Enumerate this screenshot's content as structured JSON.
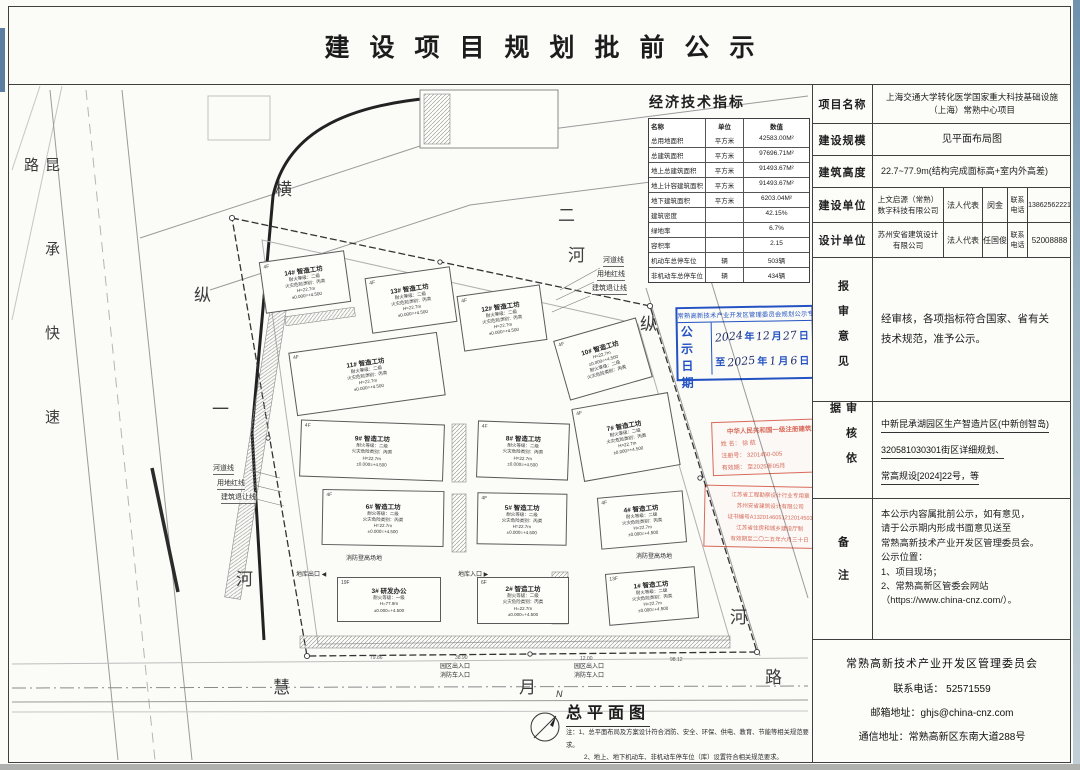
{
  "title": "建设项目规划批前公示",
  "eco_table": {
    "title": "经济技术指标",
    "headers": [
      "名称",
      "单位",
      "数值"
    ],
    "rows": [
      [
        "总用地面积",
        "平方米",
        "42583.00M²"
      ],
      [
        "总建筑面积",
        "平方米",
        "97696.71M²"
      ],
      [
        "地上总建筑面积",
        "平方米",
        "91493.67M²"
      ],
      [
        "地上计容建筑面积",
        "平方米",
        "91493.67M²"
      ],
      [
        "地下建筑面积",
        "平方米",
        "6203.04M²"
      ],
      [
        "建筑密度",
        "",
        "42.15%"
      ],
      [
        "绿地率",
        "",
        "6.7%"
      ],
      [
        "容积率",
        "",
        "2.15"
      ],
      [
        "机动车总停车位",
        "辆",
        "503辆"
      ],
      [
        "非机动车总停车位",
        "辆",
        "434辆"
      ]
    ]
  },
  "info_panel": {
    "project_label": "项目名称",
    "project_value": "上海交通大学转化医学国家重大科技基础设施\n（上海）常熟中心项目",
    "scale_label": "建设规模",
    "scale_value": "见平面布局图",
    "height_label": "建筑高度",
    "height_value": "22.7~77.9m(结构完成面标高+室内外高差)",
    "builder_label": "建设单位",
    "builder_company": "上文启源（常熟）\n数字科技有限公司",
    "builder_rep_label": "法人代表",
    "builder_rep": "闵金",
    "builder_tel_label": "联系\n电话",
    "builder_tel": "13862562221",
    "designer_label": "设计单位",
    "designer_company": "苏州安省建筑设计\n有限公司",
    "designer_rep_label": "法人代表",
    "designer_rep": "任国俊",
    "designer_tel_label": "联系\n电话",
    "designer_tel": "52008888",
    "opinion_label": "报审意见",
    "opinion_text": "经审核，各项指标符合国家、省有关\n技术规范，准予公示。",
    "basis_label": "审核依据",
    "basis_lines": [
      "中新昆承湖园区生产智造片区(中新创智岛)",
      "320581030301街区详细规划、",
      "常高规设[2024]22号，等"
    ],
    "remark_label": "备注",
    "remark_text": "本公示内容属批前公示，如有意见，\n请于公示期内形成书面意见送至\n常熟高新技术产业开发区管理委员会。\n公示位置：\n1、项目现场；\n2、常熟高新区管委会网站\n（https://www.china-cnz.com/）。",
    "footer_org": "常熟高新技术产业开发区管理委员会",
    "footer_tel": "联系电话：  52571559",
    "footer_email": "邮箱地址：ghjs@china-cnz.com",
    "footer_addr": "通信地址：常熟高新区东南大道288号"
  },
  "plan": {
    "roads": {
      "left_expressway": "昆承快速路",
      "top_river": [
        "横",
        "二",
        "河"
      ],
      "west_river": [
        "纵",
        "一",
        "河"
      ],
      "east_river": [
        "纵",
        "河"
      ],
      "south_road": [
        "慧",
        "月",
        "路"
      ]
    },
    "buildings": [
      {
        "id": "b14",
        "name": "14# 智造工坊",
        "floors": "4F",
        "lines": "耐火等级：二级\n火灾危险类别：丙类\nH=22.7m\n±0.000=+4.500",
        "x": 254,
        "y": 171,
        "w": 86,
        "h": 52,
        "rot": -8
      },
      {
        "id": "b13",
        "name": "13# 智造工坊",
        "floors": "4F",
        "lines": "耐火等级：二级\n火灾危险类别：丙类\nH=22.7m\n±0.000=+4.500",
        "x": 360,
        "y": 187,
        "w": 86,
        "h": 56,
        "rot": -8
      },
      {
        "id": "b12",
        "name": "12# 智造工坊",
        "floors": "4F",
        "lines": "耐火等级：二级\n火灾危险类别：丙类\nH=22.7m\n±0.000=+4.500",
        "x": 452,
        "y": 205,
        "w": 84,
        "h": 56,
        "rot": -8
      },
      {
        "id": "b11",
        "name": "11# 智造工坊",
        "floors": "4F",
        "lines": "耐火等级：二级\n火灾危险类别：丙类\nH=22.7m\n±0.000=+4.500",
        "x": 284,
        "y": 257,
        "w": 150,
        "h": 64,
        "rot": -8
      },
      {
        "id": "b10",
        "name": "10# 智造工坊",
        "floors": "4F",
        "lines": "H=22.7m\n±0.000=+4.500\n耐火等级：二级\n火灾危险类别：丙类",
        "x": 552,
        "y": 243,
        "w": 86,
        "h": 62,
        "rot": -16
      },
      {
        "id": "b9",
        "name": "9# 智造工坊",
        "floors": "4F",
        "lines": "耐火等级：二级\n火灾危险类别：丙类\nH=22.7m\n±0.000=+4.500",
        "x": 292,
        "y": 337,
        "w": 144,
        "h": 57,
        "rot": 2
      },
      {
        "id": "b8",
        "name": "8# 智造工坊",
        "floors": "4F",
        "lines": "耐火等级：二级\n火灾危险类别：丙类\nH=22.7m\n±0.000=+4.500",
        "x": 469,
        "y": 337,
        "w": 92,
        "h": 57,
        "rot": 2
      },
      {
        "id": "b7",
        "name": "7# 智造工坊",
        "floors": "4F",
        "lines": "耐火等级：二级\n火灾危险类别：丙类\nH=22.7m\n±0.000=+4.500",
        "x": 569,
        "y": 315,
        "w": 98,
        "h": 74,
        "rot": -10
      },
      {
        "id": "b6",
        "name": "6# 智造工坊",
        "floors": "4F",
        "lines": "耐火等级：二级\n火灾危险类别：丙类\nH=22.7m\n±0.000=+4.500",
        "x": 314,
        "y": 405,
        "w": 122,
        "h": 56,
        "rot": 1
      },
      {
        "id": "b5",
        "name": "5# 智造工坊",
        "floors": "4F",
        "lines": "耐火等级：二级\n火灾危险类别：丙类\nH=22.7m\n±0.000=+4.500",
        "x": 469,
        "y": 408,
        "w": 90,
        "h": 52,
        "rot": 1
      },
      {
        "id": "b4",
        "name": "4# 智造工坊",
        "floors": "4F",
        "lines": "耐火等级：二级\n火灾危险类别：丙类\nH=22.7m\n±0.000=+4.500",
        "x": 591,
        "y": 409,
        "w": 86,
        "h": 52,
        "rot": -5
      },
      {
        "id": "b3",
        "name": "3# 研发办公",
        "floors": "19F",
        "lines": "耐火等级：一级\nH=77.9m\n±0.000=+4.500",
        "x": 329,
        "y": 492,
        "w": 104,
        "h": 45,
        "rot": 0
      },
      {
        "id": "b2",
        "name": "2# 智造工坊",
        "floors": "6F",
        "lines": "耐火等级：二级\n火灾危险类别：丙类\nH=22.7m\n±0.000=+4.500",
        "x": 469,
        "y": 492,
        "w": 92,
        "h": 47,
        "rot": 0
      },
      {
        "id": "b1",
        "name": "1# 智造工坊",
        "floors": "13F",
        "lines": "耐火等级：二级\n火灾危险类别：丙类\nH=22.7m\n±0.000=+4.500",
        "x": 599,
        "y": 485,
        "w": 90,
        "h": 52,
        "rot": -5
      }
    ],
    "labels": {
      "river_line": "河道线",
      "red_line": "用地红线",
      "setback_line": "建筑退让线",
      "fire_field": "消防登高场地",
      "garage_exit": "地库出口 ◀",
      "garage_entry": "地库入口 ▶",
      "entrance": "园区出入口\n消防车入口",
      "dims": [
        "79.86",
        "38.90",
        "12.00",
        "98.12"
      ]
    }
  },
  "stamps": {
    "blue": {
      "header": "常熟高新技术产业开发区管理委员会规划公示专用章",
      "left1": "公示",
      "left2": "日期",
      "y1": "2024",
      "m1": "12",
      "d1": "27",
      "to": "至",
      "y2": "2025",
      "m2": "1",
      "d2": "6",
      "u_year": "年",
      "u_month": "月",
      "u_day": "日",
      "color": "#2353c8"
    },
    "arch": {
      "lines": [
        "中华人民共和国一级注册建筑师",
        "姓 名： 徐 航",
        "注册号： 3201450-005",
        "有效期： 至2025年05月"
      ],
      "color": "#d9604f"
    },
    "firm": {
      "lines": [
        "江苏省工程勘察设计行业专用章",
        "苏州安省建筑设计有限公司",
        "证书编号A1320146051212014503",
        "江苏省住房和城乡建设厅制",
        "有效期至二〇二五年六月三十日"
      ],
      "color": "#d9604f"
    }
  },
  "legend": {
    "north": "N",
    "title": "总平面图",
    "note1": "注：1、总平面布局及方案设计符合消防、安全、环保、供电、教育、节能等相关规范要求。",
    "note2": "2、地上、地下机动车、非机动车停车位（库）设置符合相关规范要求。"
  }
}
